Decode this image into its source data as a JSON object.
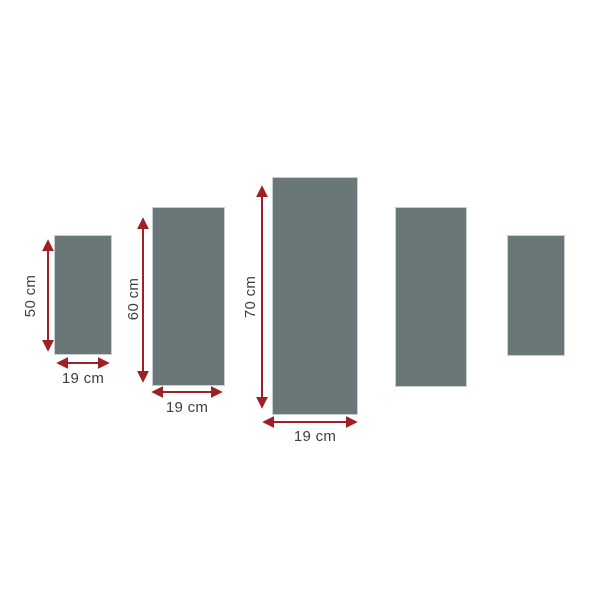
{
  "diagram": {
    "background": "#ffffff",
    "panel_fill": "#697779",
    "panel_border": "#c9cfcf",
    "arrow_color": "#9e2126",
    "label_color": "#3f3f3f",
    "panels": [
      {
        "height_label": "50 cm",
        "width_label": "19 cm"
      },
      {
        "height_label": "60 cm",
        "width_label": "19 cm"
      },
      {
        "height_label": "70 cm",
        "width_label": "19 cm"
      },
      {},
      {}
    ]
  }
}
